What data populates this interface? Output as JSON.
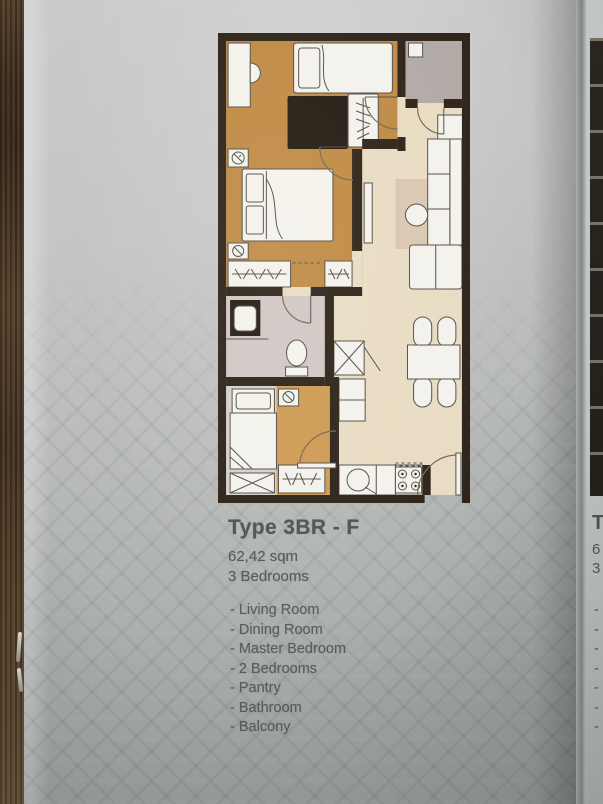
{
  "page": {
    "plan_title": "Type 3BR - F",
    "plan_area": "62,42 sqm",
    "plan_bedrooms": "3 Bedrooms",
    "features": [
      "- Living Room",
      "- Dining Room",
      "- Master Bedroom",
      "- 2 Bedrooms",
      "- Pantry",
      "- Bathroom",
      "- Balcony"
    ]
  },
  "floorplan": {
    "colors": {
      "wall": "#2e2419",
      "wood": "#c08a45",
      "wood2": "#cf9b55",
      "beige": "#e8dcc3",
      "rug": "#dbc7b2",
      "balcony": "#b1aaa6",
      "bath": "#d1c7c5",
      "bed3": "#d7d1cd",
      "furniture": "#f4f2ec",
      "dark": "#241c12",
      "line": "#55504a",
      "text": "#53585c"
    }
  },
  "adjacent_page": {
    "title_fragment": "T",
    "area_fragment": "6",
    "bedrooms_fragment": "3",
    "list_dashes": [
      "-",
      "-",
      "-",
      "-",
      "-",
      "-",
      "-"
    ]
  }
}
